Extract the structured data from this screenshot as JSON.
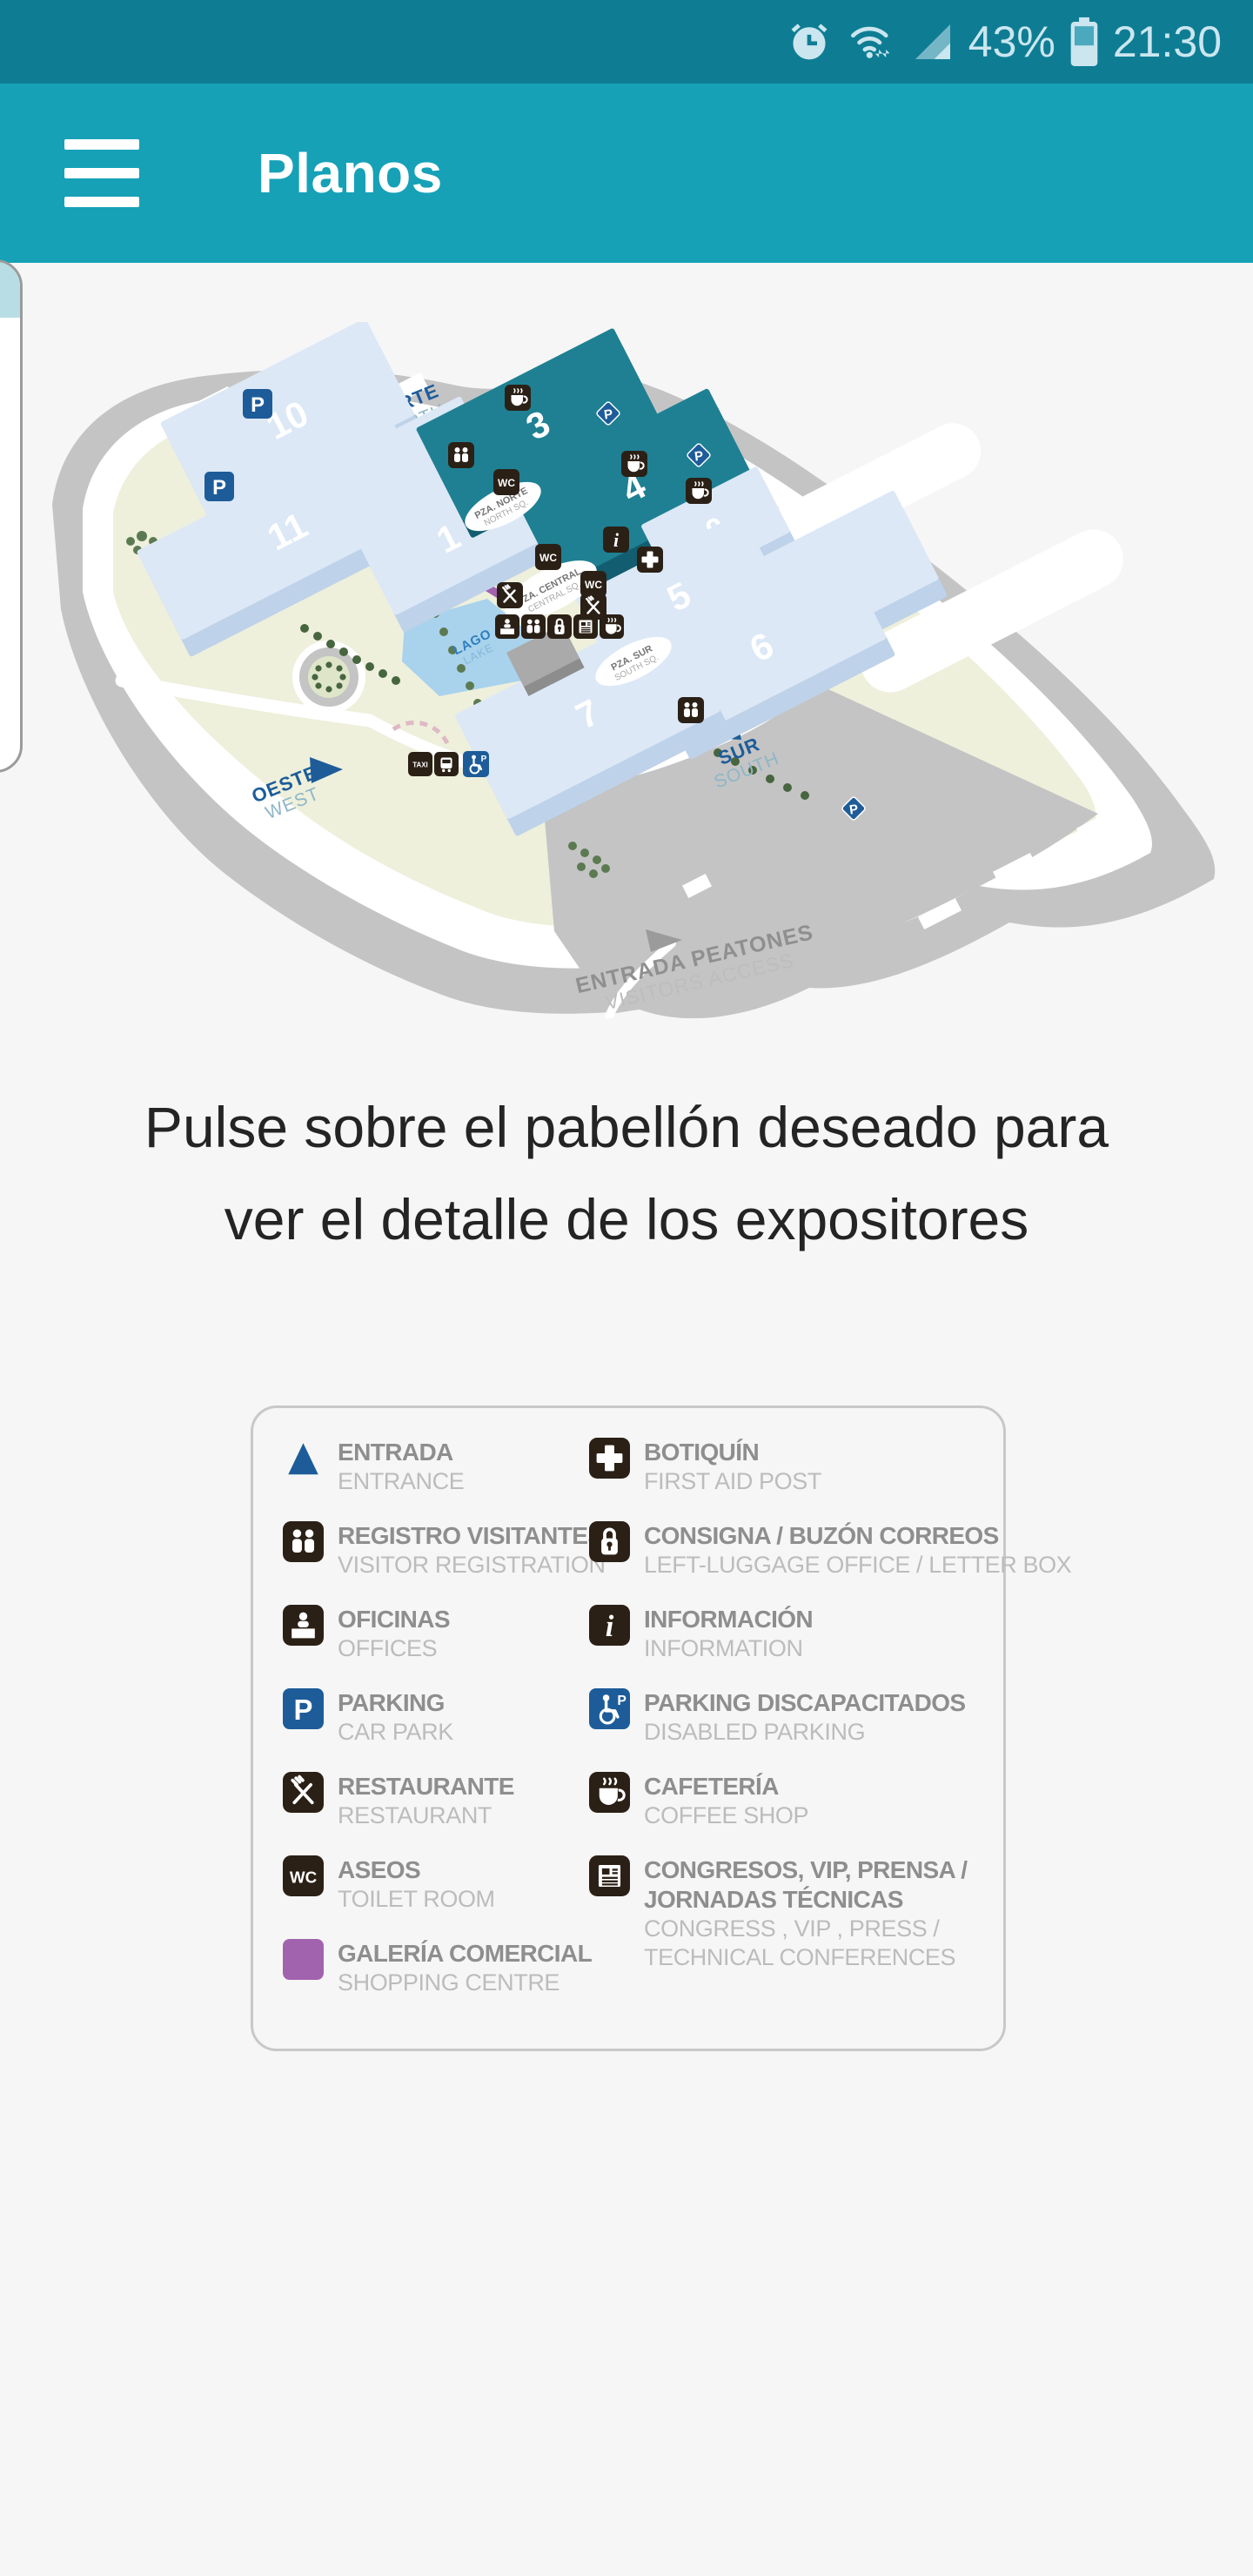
{
  "status_bar": {
    "battery_percent": "43%",
    "time": "21:30"
  },
  "app_bar": {
    "title": "Planos"
  },
  "map": {
    "pavilions": [
      {
        "number": "10",
        "highlighted": false
      },
      {
        "number": "2",
        "highlighted": false
      },
      {
        "number": "11",
        "highlighted": false
      },
      {
        "number": "1",
        "highlighted": false
      },
      {
        "number": "3",
        "highlighted": true
      },
      {
        "number": "4",
        "highlighted": true
      },
      {
        "number": "9",
        "highlighted": false
      },
      {
        "number": "8",
        "highlighted": false
      },
      {
        "number": "5",
        "highlighted": false
      },
      {
        "number": "6",
        "highlighted": false
      },
      {
        "number": "7",
        "highlighted": false
      }
    ],
    "entrances": {
      "north": {
        "name": "NORTE",
        "name_en": "NORTH"
      },
      "south": {
        "name": "SUR",
        "name_en": "SOUTH"
      },
      "west": {
        "name": "OESTE",
        "name_en": "WEST"
      }
    },
    "pedestrian": {
      "name": "ENTRADA PEATONES",
      "name_en": "VISITORS ACCESS"
    },
    "squares": {
      "north": {
        "name": "PZA. NORTE",
        "name_en": "NORTH SQ."
      },
      "central": {
        "name": "PZA. CENTRAL",
        "name_en": "CENTRAL SQ."
      },
      "south": {
        "name": "PZA. SUR",
        "name_en": "SOUTH SQ."
      }
    },
    "lake": {
      "name": "LAGO",
      "name_en": "LAKE"
    }
  },
  "instruction": {
    "line1": "Pulse sobre el pabellón deseado para",
    "line2": "ver el detalle de los expositores"
  },
  "legend": {
    "left": [
      {
        "icon": "entrance-triangle-icon",
        "title": "ENTRADA",
        "subtitle": "ENTRANCE"
      },
      {
        "icon": "visitor-registration-icon",
        "title": "REGISTRO VISITANTES",
        "subtitle": "VISITOR REGISTRATION"
      },
      {
        "icon": "offices-icon",
        "title": "OFICINAS",
        "subtitle": "OFFICES"
      },
      {
        "icon": "parking-icon",
        "title": "PARKING",
        "subtitle": "CAR PARK"
      },
      {
        "icon": "restaurant-icon",
        "title": "RESTAURANTE",
        "subtitle": "RESTAURANT"
      },
      {
        "icon": "toilets-icon",
        "title": "ASEOS",
        "subtitle": "TOILET ROOM"
      },
      {
        "icon": "shopping-gallery-icon",
        "title": "GALERÍA COMERCIAL",
        "subtitle": "SHOPPING CENTRE"
      }
    ],
    "right": [
      {
        "icon": "first-aid-icon",
        "title": "BOTIQUÍN",
        "subtitle": "FIRST AID POST"
      },
      {
        "icon": "left-luggage-icon",
        "title": "CONSIGNA / BUZÓN CORREOS",
        "subtitle": "LEFT-LUGGAGE OFFICE / LETTER BOX"
      },
      {
        "icon": "information-icon",
        "title": "INFORMACIÓN",
        "subtitle": "INFORMATION"
      },
      {
        "icon": "disabled-parking-icon",
        "title": "PARKING DISCAPACITADOS",
        "subtitle": "DISABLED PARKING"
      },
      {
        "icon": "coffee-shop-icon",
        "title": "CAFETERÍA",
        "subtitle": "COFFEE SHOP"
      },
      {
        "icon": "congress-icon",
        "title": "CONGRESOS, VIP, PRENSA /",
        "title2": "JORNADAS TÉCNICAS",
        "subtitle": "CONGRESS , VIP , PRESS /",
        "subtitle2": "TECHNICAL CONFERENCES"
      }
    ]
  },
  "colors": {
    "status_bar": "#0e7d94",
    "app_bar": "#16a1b7",
    "highlight_pavilion": "#1f8093",
    "pavilion": "#dce8f6",
    "parking_blue": "#1d5c99",
    "gallery_purple": "#a263ae",
    "icon_dark": "#2b2016"
  }
}
